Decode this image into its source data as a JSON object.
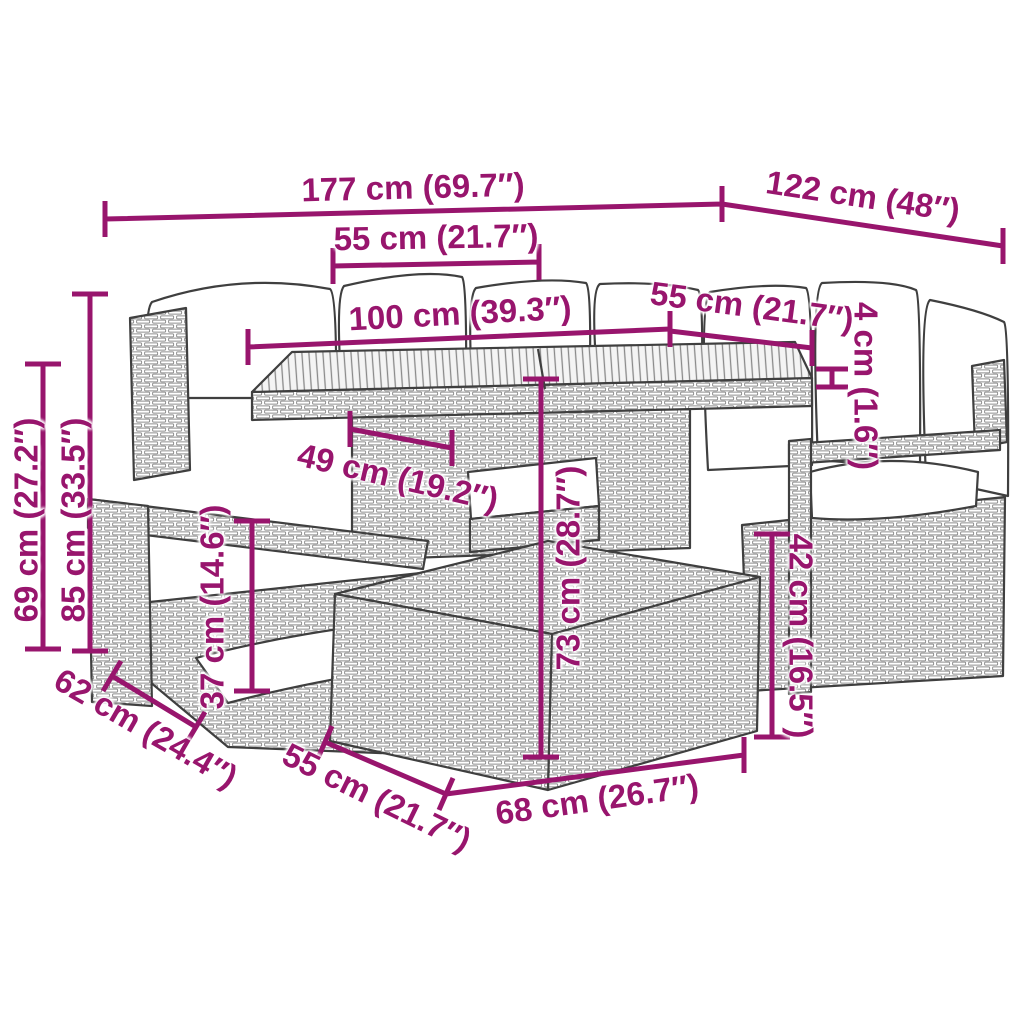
{
  "diagram": {
    "illustration": "rattan-garden-lounge-set-with-table-line-art",
    "accent_color": "#98156D",
    "line_color": "#3F3F3F"
  },
  "dims": {
    "total_width": {
      "label": "177 cm (69.7″)"
    },
    "total_depth": {
      "label": "122 cm (48″)"
    },
    "seat_width_back": {
      "label": "55 cm (21.7″)"
    },
    "table_length": {
      "label": "100 cm (39.3″)"
    },
    "table_width": {
      "label": "55 cm (21.7″)"
    },
    "tabletop_thickness": {
      "label": "4 cm (1.6″)"
    },
    "table_clearance": {
      "label": "49 cm (19.2″)"
    },
    "ottoman_height": {
      "label": "37 cm (14.6″)"
    },
    "table_height": {
      "label": "73 cm (28.7″)"
    },
    "seat_height": {
      "label": "42 cm (16.5″)"
    },
    "back_height": {
      "label": "85 cm (33.5″)"
    },
    "arm_height": {
      "label": "69 cm (27.2″)"
    },
    "seat_depth": {
      "label": "62 cm (24.4″)"
    },
    "ottoman_width": {
      "label": "55 cm (21.7″)"
    },
    "ottoman_length": {
      "label": "68 cm (26.7″)"
    }
  }
}
